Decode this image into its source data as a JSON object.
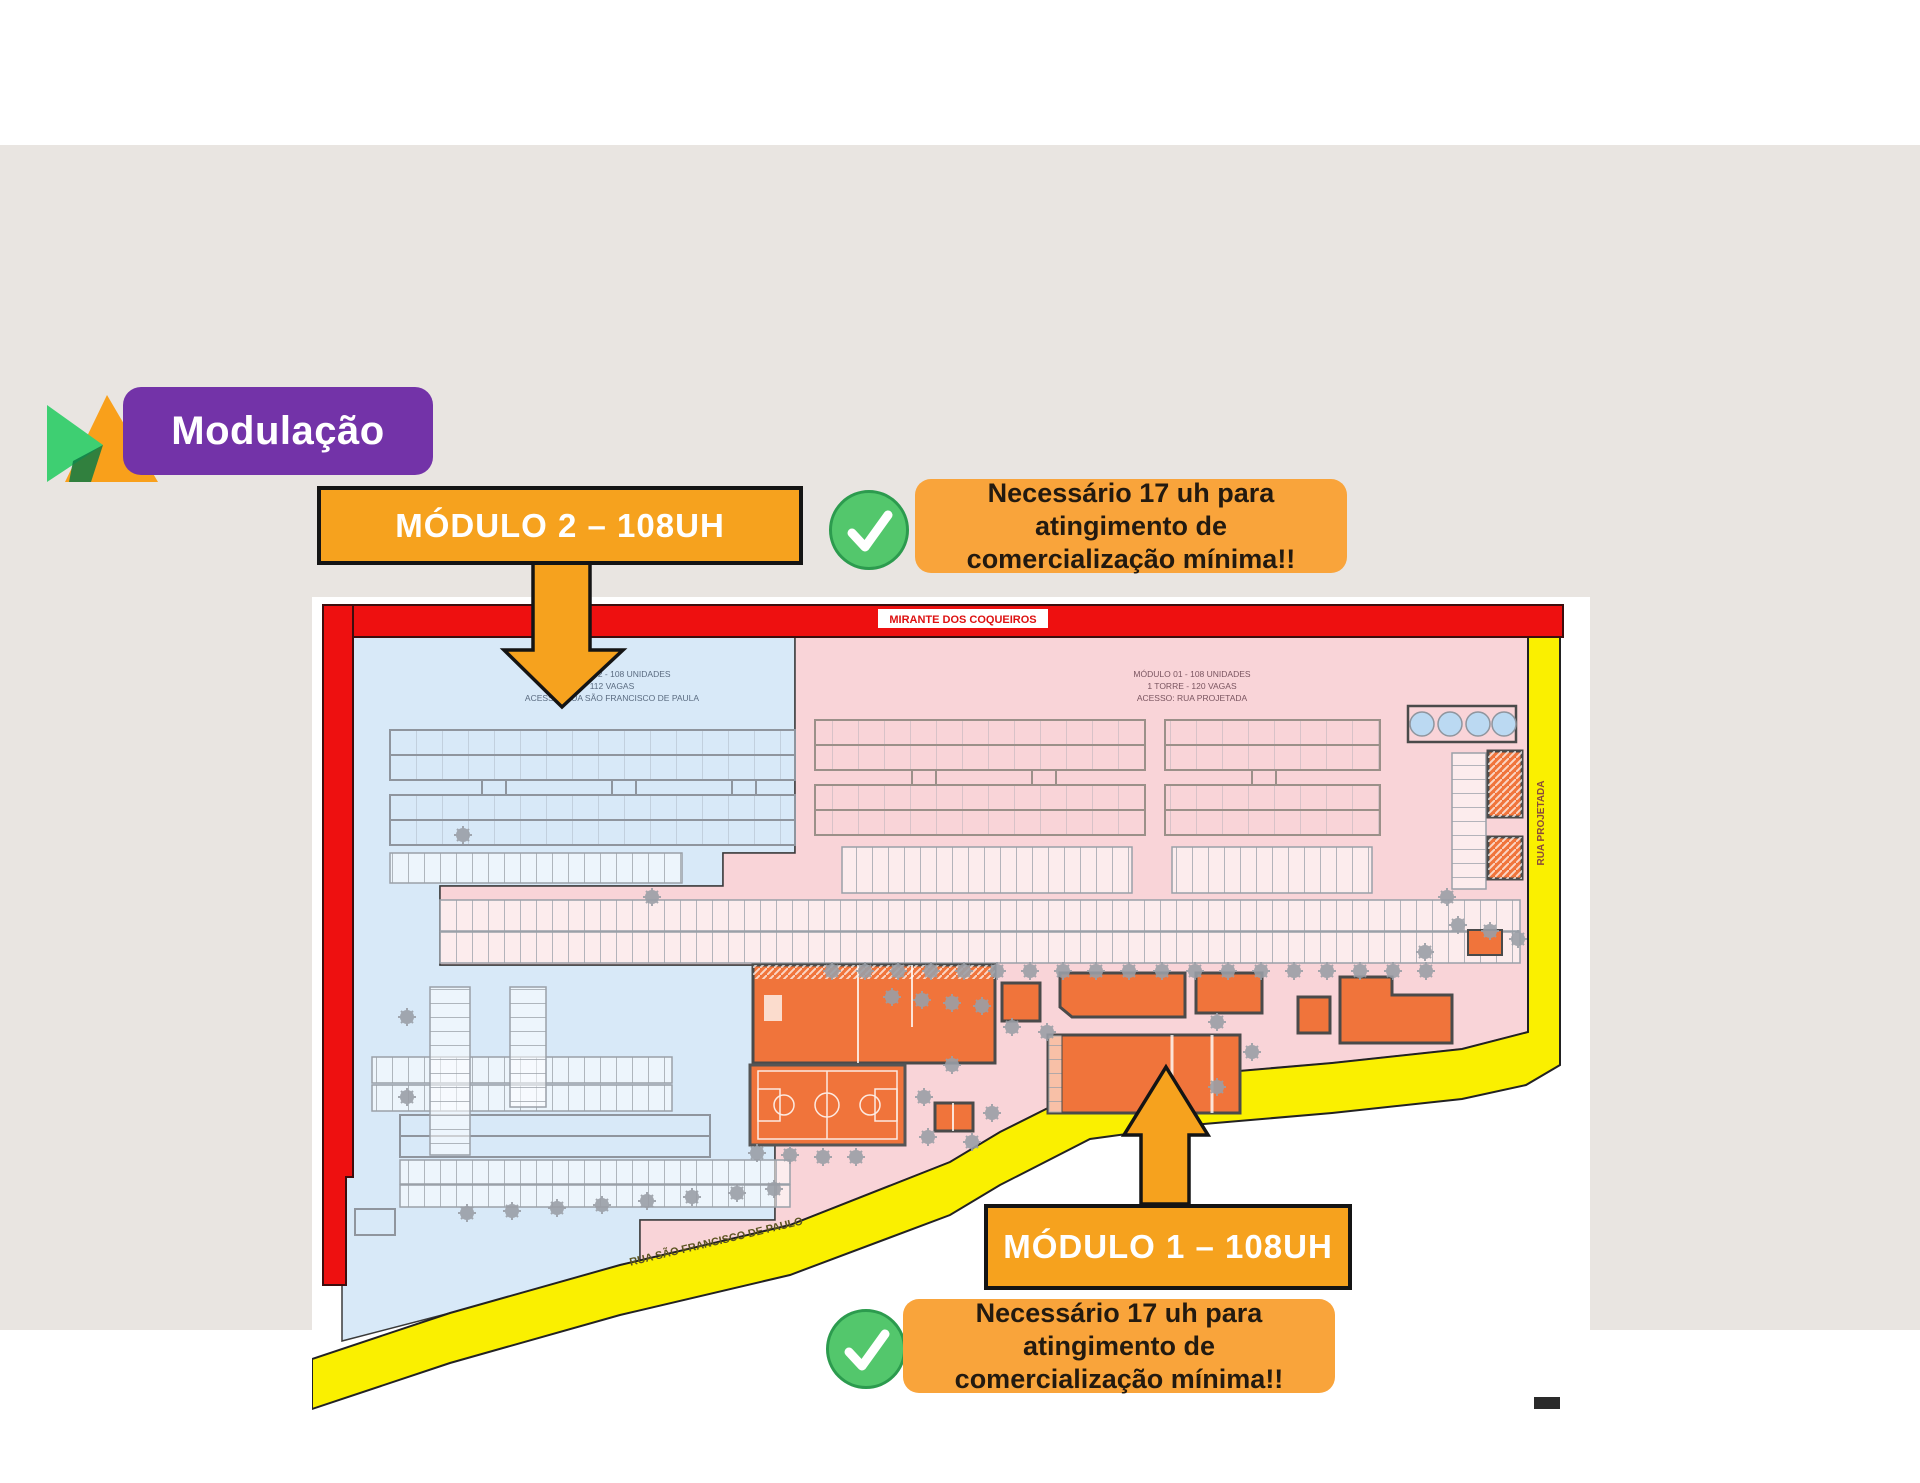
{
  "title": {
    "text": "Modulação"
  },
  "logo": {
    "green": "#3ECF72",
    "orange": "#F9A01B",
    "overlap": "#0E7A44"
  },
  "colors": {
    "canvas_beige": "#E9E5E1",
    "title_purple": "#7333A8",
    "callout_orange": "#F6A21E",
    "note_orange": "#F9A43B",
    "check_green": "#53C76C",
    "plan_border_red": "#EE1010",
    "road_yellow": "#FAF000",
    "module2_blue": "#D8E9F8",
    "module1_pink": "#F9D4D8",
    "building_orange": "#F0743B"
  },
  "callouts": {
    "module2": {
      "label": "MÓDULO 2 – 108UH"
    },
    "module1": {
      "label": "MÓDULO 1 – 108UH"
    },
    "note_top": {
      "line1": "Necessário 17 uh para atingimento de",
      "line2": "comercialização mínima!!"
    },
    "note_bottom": {
      "line1": "Necessário 17 uh para atingimento de",
      "line2": "comercialização mínima!!"
    }
  },
  "plan": {
    "street_top": "MIRANTE DOS COQUEIROS",
    "street_right": "RUA PROJETADA",
    "street_bottom": "RUA SÃO FRANCISCO DE PAULO",
    "module2_annotation": {
      "line1": "MÓDULO 02 - 108 UNIDADES",
      "line2": "112 VAGAS",
      "line3": "ACESSO: RUA SÃO FRANCISCO DE PAULA"
    },
    "module1_annotation": {
      "line1": "MÓDULO 01 - 108 UNIDADES",
      "line2": "1 TORRE - 120 VAGAS",
      "line3": "ACESSO: RUA PROJETADA"
    }
  }
}
